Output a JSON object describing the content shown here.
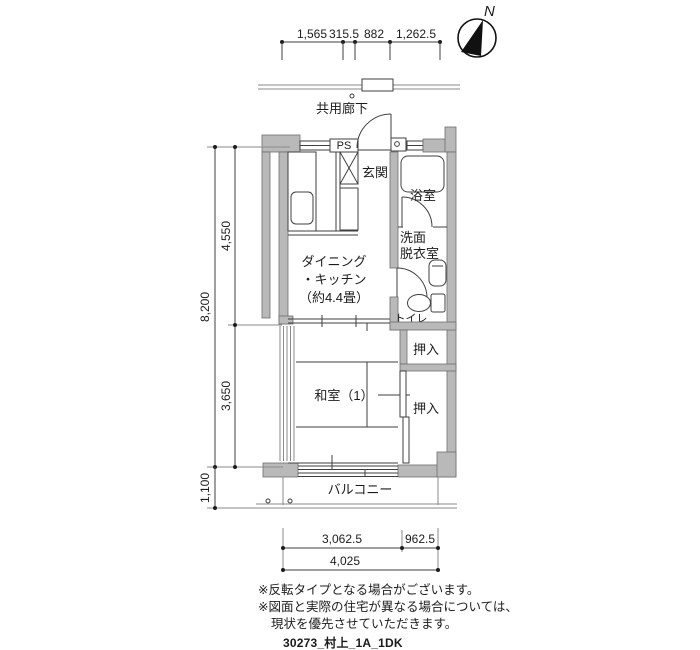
{
  "compass": {
    "north_label": "N"
  },
  "dimensions": {
    "top": [
      "1,565",
      "315.5",
      "882",
      "1,262.5"
    ],
    "left": {
      "total": "8,200",
      "upper": "4,550",
      "lower": "3,650",
      "balcony": "1,100"
    },
    "bottom": {
      "seg1": "3,062.5",
      "seg2": "962.5",
      "total": "4,025"
    }
  },
  "rooms": {
    "corridor": "共用廊下",
    "pipe_shaft": "PS",
    "entrance": "玄関",
    "bathroom": "浴室",
    "dining_kitchen_line1": "ダイニング",
    "dining_kitchen_line2": "・キッチン",
    "dining_kitchen_line3": "（約4.4畳）",
    "washroom_line1": "洗面",
    "washroom_line2": "脱衣室",
    "toilet": "トイレ",
    "closet_upper": "押入",
    "closet_lower": "押入",
    "japanese_room": "和室（1）",
    "balcony": "バルコニー"
  },
  "notes": [
    "※反転タイプとなる場合がございます。",
    "※図面と実際の住宅が異なる場合については、",
    "現状を優先させていただきます。"
  ],
  "drawing_id": "30273_村上_1A_1DK",
  "colors": {
    "wall": "#b9b9b9",
    "line": "#3f3f3f",
    "background": "#ffffff"
  }
}
